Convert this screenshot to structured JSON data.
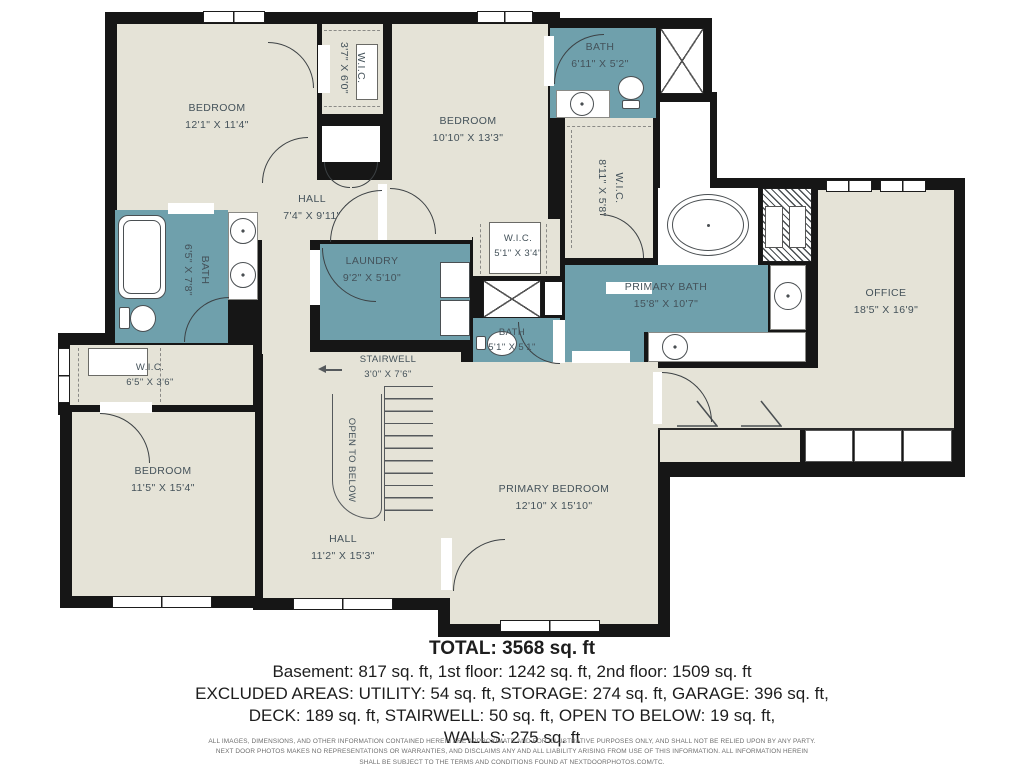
{
  "plan": {
    "rooms": {
      "bedroom_tl": {
        "name": "BEDROOM",
        "dims": "12'1\" X 11'4\""
      },
      "wic_tl": {
        "name": "W.I.C.",
        "dims": "3'7\" X 6'0\""
      },
      "bedroom_tm": {
        "name": "BEDROOM",
        "dims": "10'10\" X 13'3\""
      },
      "bath_tr": {
        "name": "BATH",
        "dims": "6'11\" X 5'2\""
      },
      "wic_r": {
        "name": "W.I.C.",
        "dims": "8'11\" X 5'8\""
      },
      "hall_top": {
        "name": "HALL",
        "dims": "7'4\" X 9'11\""
      },
      "bath_left": {
        "name": "BATH",
        "dims": "6'5\" X 7'8\""
      },
      "laundry": {
        "name": "LAUNDRY",
        "dims": "9'2\" X 5'10\""
      },
      "wic_center": {
        "name": "W.I.C.",
        "dims": "5'1\" X 3'4\""
      },
      "primary_bath": {
        "name": "PRIMARY BATH",
        "dims": "15'8\" X 10'7\""
      },
      "office": {
        "name": "OFFICE",
        "dims": "18'5\" X 16'9\""
      },
      "bath_center": {
        "name": "BATH",
        "dims": "5'1\" X 5'1\""
      },
      "wic_bl": {
        "name": "W.I.C.",
        "dims": "6'5\" X 3'6\""
      },
      "stairwell": {
        "name": "STAIRWELL",
        "dims": "3'0\" X 7'6\""
      },
      "open_to_below": {
        "name": "OPEN TO BELOW"
      },
      "bedroom_bl": {
        "name": "BEDROOM",
        "dims": "11'5\" X 15'4\""
      },
      "hall_bottom": {
        "name": "HALL",
        "dims": "11'2\" X 15'3\""
      },
      "primary_bedroom": {
        "name": "PRIMARY BEDROOM",
        "dims": "12'10\" X 15'10\""
      }
    },
    "icons": {
      "bathtub": "css-rounded-rect",
      "oval-tub": "css-ellipse",
      "sink": "css-circle",
      "toilet": "css-oval-plus-tank",
      "shower": "css-x-box",
      "washer-dryer": "css-squares",
      "stairs": "css-tread-lines",
      "direction-arrow": "css-left-arrow",
      "attic-marker": "svg-triangle",
      "window": "css-white-bar",
      "door": "css-quarter-arc"
    },
    "colors": {
      "wall": "#161616",
      "room": "#e5e3d7",
      "wet_room": "#6fa0ac",
      "label_text": "#44525a"
    }
  },
  "summary": {
    "total": "TOTAL: 3568 sq. ft",
    "line1": "Basement: 817 sq. ft, 1st floor: 1242 sq. ft, 2nd floor: 1509 sq. ft",
    "line2": "EXCLUDED AREAS: UTILITY: 54 sq. ft, STORAGE: 274 sq. ft, GARAGE: 396 sq. ft,",
    "line3": "DECK: 189 sq. ft, STAIRWELL: 50 sq. ft, OPEN TO BELOW: 19 sq. ft,",
    "line4": "WALLS: 275 sq. ft"
  },
  "disclaimer": {
    "line1": "ALL IMAGES, DIMENSIONS, AND OTHER INFORMATION CONTAINED HEREIN ARE APPROXIMATE AND FOR ILLUSTRATIVE PURPOSES ONLY, AND SHALL NOT BE RELIED UPON BY ANY PARTY.",
    "line2": "NEXT DOOR PHOTOS MAKES NO REPRESENTATIONS OR WARRANTIES, AND DISCLAIMS ANY AND ALL LIABILITY ARISING FROM USE OF THIS INFORMATION. ALL INFORMATION HEREIN",
    "line3": "SHALL BE SUBJECT TO THE TERMS AND CONDITIONS FOUND AT NEXTDOORPHOTOS.COM/TC."
  }
}
